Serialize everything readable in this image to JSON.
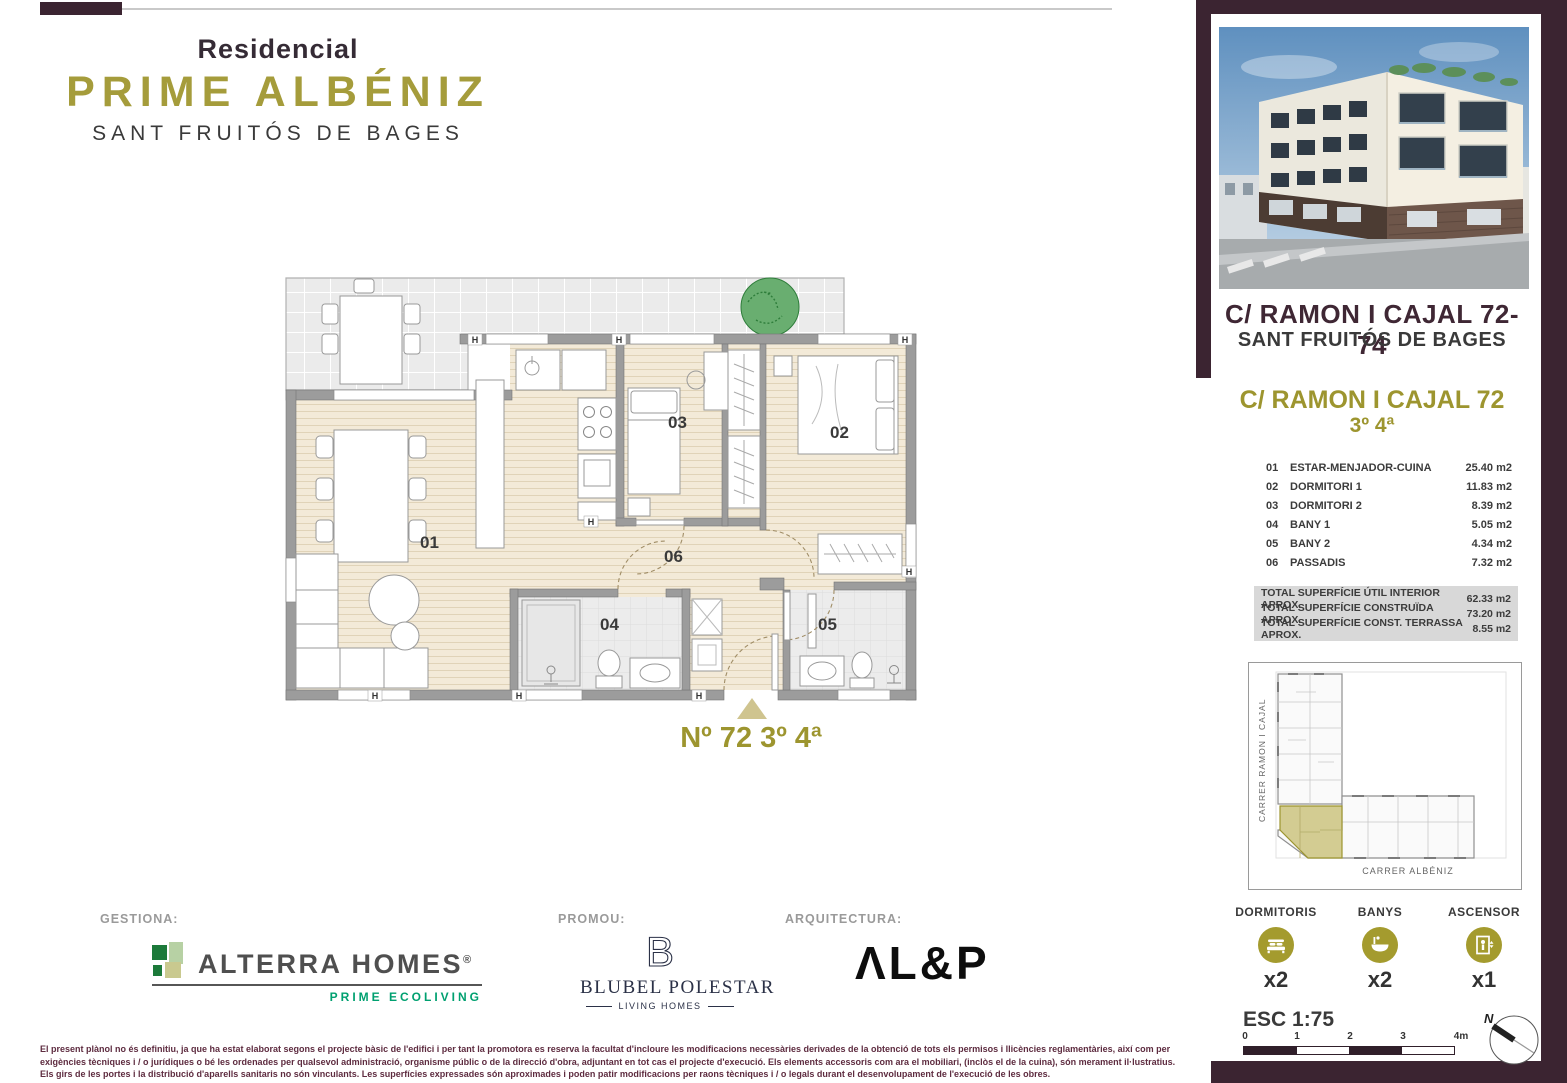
{
  "colors": {
    "maroon": "#3b2431",
    "olive": "#9d952f",
    "olive_icon": "#a49b2e",
    "khaki": "#cfc48f",
    "green": "#00a070",
    "navy": "#2b3147"
  },
  "header": {
    "residencial": "Residencial",
    "title": "PRIME ALBÉNIZ",
    "subtitle": "SANT FRUITÓS DE BAGES"
  },
  "plan": {
    "h": "H",
    "labels": [
      "01",
      "02",
      "03",
      "04",
      "05",
      "06"
    ],
    "unit_label": "Nº 72 3º 4ª"
  },
  "sidebar": {
    "address_line1": "C/ RAMON I CAJAL 72-74",
    "address_line2": "SANT FRUITÓS DE BAGES",
    "unit_heading": "C/ RAMON I CAJAL 72",
    "unit_floor": "3º 4ª",
    "rooms": [
      {
        "num": "01",
        "name": "ESTAR-MENJADOR-CUINA",
        "area": "25.40 m2"
      },
      {
        "num": "02",
        "name": "DORMITORI 1",
        "area": "11.83 m2"
      },
      {
        "num": "03",
        "name": "DORMITORI 2",
        "area": "8.39 m2"
      },
      {
        "num": "04",
        "name": "BANY 1",
        "area": "5.05 m2"
      },
      {
        "num": "05",
        "name": "BANY 2",
        "area": "4.34 m2"
      },
      {
        "num": "06",
        "name": "PASSADIS",
        "area": "7.32 m2"
      }
    ],
    "totals": [
      {
        "label": "TOTAL SUPERFÍCIE ÚTIL INTERIOR APROX.",
        "value": "62.33 m2"
      },
      {
        "label": "TOTAL SUPERFÍCIE CONSTRUÏDA APROX.",
        "value": "73.20 m2"
      },
      {
        "label": "TOTAL SUPERFÍCIE CONST. TERRASSA APROX.",
        "value": "8.55 m2"
      }
    ],
    "siteplan": {
      "street_left": "CARRER RAMON I CAJAL",
      "street_bottom": "CARRER ALBÉNIZ"
    },
    "features": [
      {
        "label": "DORMITORIS",
        "count": "x2",
        "icon": "bed-icon"
      },
      {
        "label": "BANYS",
        "count": "x2",
        "icon": "bath-icon"
      },
      {
        "label": "ASCENSOR",
        "count": "x1",
        "icon": "elevator-icon"
      }
    ],
    "scale_label": "ESC 1:75",
    "scale_ticks": [
      "0",
      "1",
      "2",
      "3",
      "4m"
    ],
    "compass_n": "N"
  },
  "footer": {
    "gestiona_label": "GESTIONA:",
    "alterra_name": "ALTERRA HOMES",
    "alterra_reg": "®",
    "alterra_tagline": "PRIME ECOLIVING",
    "promou_label": "PROMOU:",
    "blubel_b": "B",
    "blubel_name": "BLUBEL POLESTAR",
    "blubel_tagline": "LIVING HOMES",
    "arquitectura_label": "ARQUITECTURA:",
    "alp_name": "ΛL&P",
    "disclaimer": "El present plànol no és definitiu, ja que ha estat elaborat segons el projecte bàsic de l'edifici i per tant la promotora es reserva la facultat d'incloure les modificacions necessàries derivades de la obtenció de tots els permisos i llicències reglamentàries, així com per exigències tècniques i / o jurídiques o bé les ordenades per qualsevol administració, organisme públic o de la direcció d'obra, adjuntant en tot cas el projecte d'execució. Els elements accessoris com ara el mobiliari, (inclòs el de la cuina), són merament il·lustratius. Els girs de les portes i la distribució d'aparells sanitaris no són vinculants. Les superfícies expressades són aproximades i poden patir modificacions per raons tècniques i / o legals durant el desenvolupament de l'execució de les obres."
  }
}
